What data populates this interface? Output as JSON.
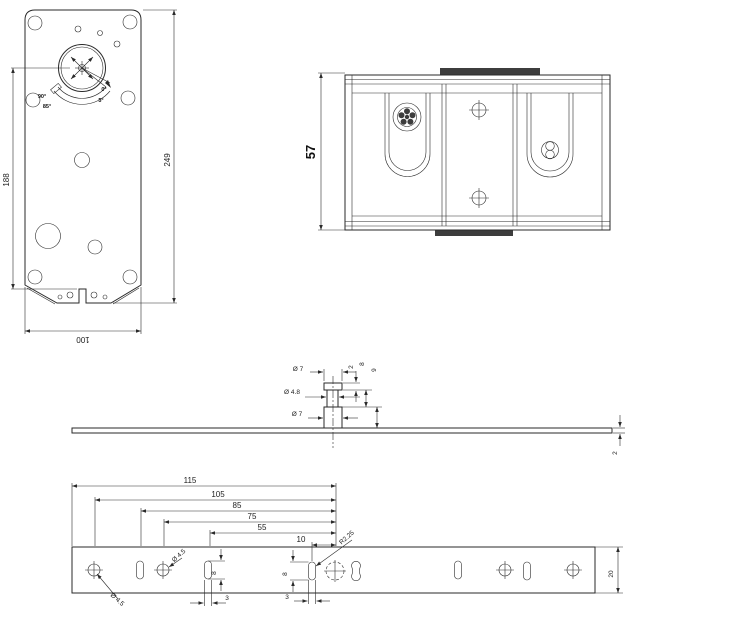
{
  "meta": {
    "background_color": "#ffffff",
    "line_color": "#2a2a2a",
    "drawing_type": "damper-actuator-and-bracket-technical-drawing"
  },
  "front_view": {
    "dim_height_partial": "188",
    "dim_height_total": "249",
    "dim_width": "100",
    "angle_labels": {
      "left_outer": "90°",
      "left_inner": "85°",
      "right_outer": "0°",
      "right_inner": "5°"
    }
  },
  "side_view": {
    "dim_height": "57"
  },
  "section_view": {
    "dia_cap": "Ø 7",
    "dia_neck": "Ø 4.8",
    "dia_base": "Ø 7",
    "h_cap": "2",
    "h_neck": "8",
    "h_base": "9",
    "thickness": "2"
  },
  "bracket_view": {
    "len_115": "115",
    "len_105": "105",
    "len_85": "85",
    "len_75": "75",
    "len_55": "55",
    "len_10": "10",
    "radius_slot": "R2.25",
    "dia_hole_left": "Ø 4.5",
    "dia_hole_mid": "Ø 4.5",
    "slot_w_left": "3",
    "slot_w_mid": "3",
    "slot_h_left": "8",
    "slot_h_mid": "8",
    "width": "20"
  }
}
